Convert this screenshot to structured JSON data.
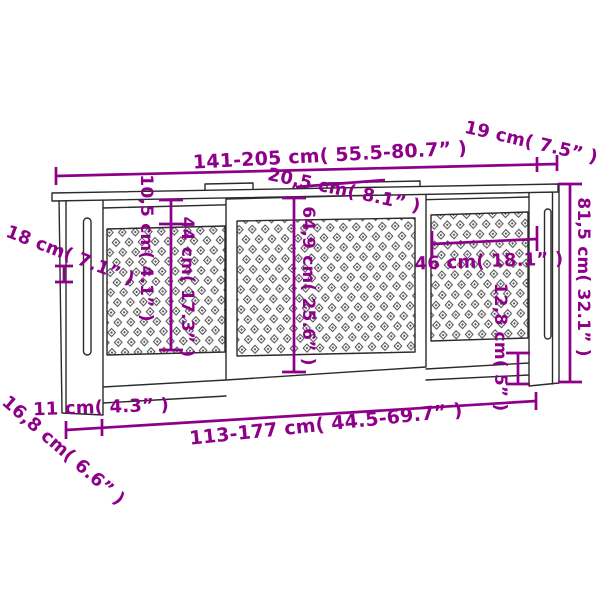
{
  "diagram": {
    "subject": "radiator-cover-dimension-drawing",
    "colors": {
      "dimension": "#8E0089",
      "outline": "#2b2b2b",
      "background": "#ffffff",
      "lattice": "#4d4d4d"
    },
    "labels": {
      "total_width": "141-205 cm( 55.5-80.7” )",
      "side_top_depth": "19 cm( 7.5” )",
      "top_shelf_depth": "20,5 cm( 8.1” )",
      "side_panel_depth": "18 cm( 7.1” )",
      "top_rail_height": "10,5 cm( 4.1” )",
      "side_lattice_height": "44 cm( 17.3” )",
      "front_panel_height": "64,9 cm( 25.6” )",
      "side_lattice_width": "46 cm( 18.1” )",
      "bottom_clearance": "12,8 cm( 5” )",
      "total_height": "81,5 cm( 32.1” )",
      "leg_width": "11 cm( 4.3” )",
      "base_depth": "16,8 cm( 6.6” )",
      "inner_width": "113-177 cm( 44.5-69.7” )"
    }
  }
}
